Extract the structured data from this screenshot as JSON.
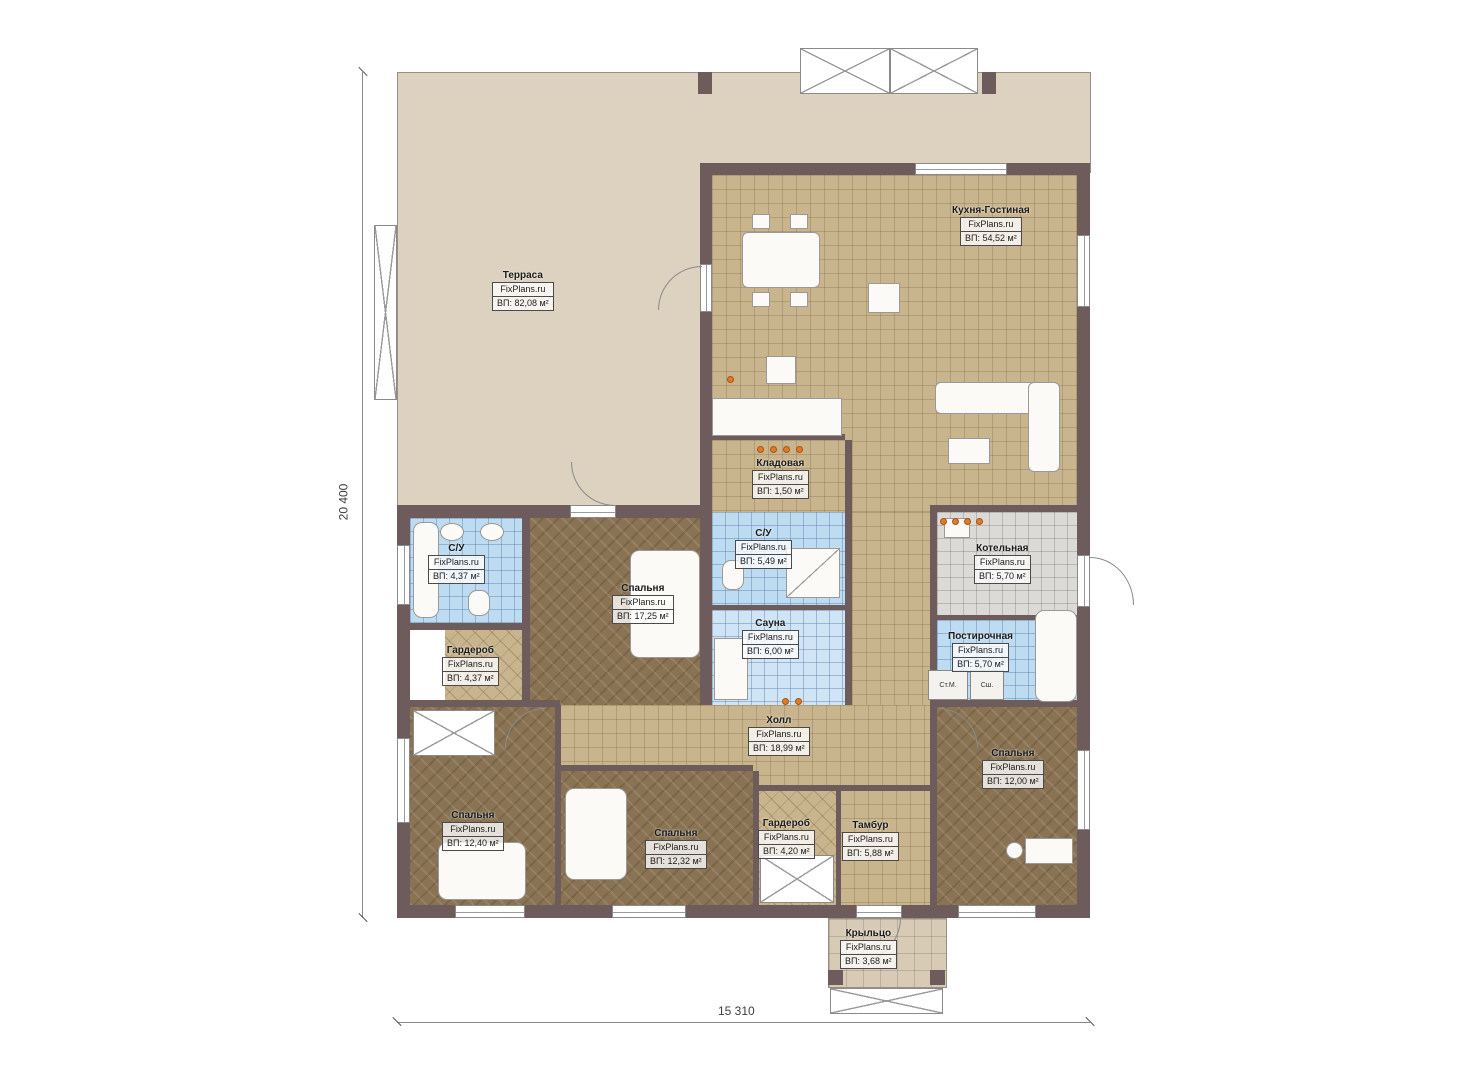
{
  "brand": "FixPlans.ru",
  "plan": {
    "dimensions": {
      "vertical": "20 400",
      "horizontal": "15 310"
    },
    "rooms": [
      {
        "name": "Терраса",
        "area": "ВП: 82,08 м²"
      },
      {
        "name": "Кухня-Гостиная",
        "area": "ВП: 54,52 м²"
      },
      {
        "name": "Кладовая",
        "area": "ВП: 1,50 м²"
      },
      {
        "name": "С/У",
        "area": "ВП: 4,37 м²"
      },
      {
        "name": "Спальня",
        "area": "ВП: 17,25 м²"
      },
      {
        "name": "С/У",
        "area": "ВП: 5,49 м²"
      },
      {
        "name": "Котельная",
        "area": "ВП: 5,70 м²"
      },
      {
        "name": "Гардероб",
        "area": "ВП: 4,37 м²"
      },
      {
        "name": "Сауна",
        "area": "ВП: 6,00 м²"
      },
      {
        "name": "Постирочная",
        "area": "ВП: 5,70 м²"
      },
      {
        "name": "Холл",
        "area": "ВП: 18,99 м²"
      },
      {
        "name": "Спальня",
        "area": "ВП: 12,00 м²"
      },
      {
        "name": "Спальня",
        "area": "ВП: 12,40 м²"
      },
      {
        "name": "Спальня",
        "area": "ВП: 12,32 м²"
      },
      {
        "name": "Гардероб",
        "area": "ВП: 4,20 м²"
      },
      {
        "name": "Тамбур",
        "area": "ВП: 5,88 м²"
      },
      {
        "name": "Крыльцо",
        "area": "ВП: 3,68 м²"
      }
    ],
    "appliances": {
      "washer": "Ст.М.",
      "dryer": "Сш."
    },
    "colors": {
      "wall": "#6e5c5c",
      "terrace": "#ddd1c0",
      "tile_tan": "#c9b58d",
      "floor_brown": "#8a7352",
      "tile_blue": "#bedcf1",
      "tile_gray": "#dbdad7",
      "porch": "#d8cbb6",
      "accent_orange": "#e07b28"
    }
  }
}
